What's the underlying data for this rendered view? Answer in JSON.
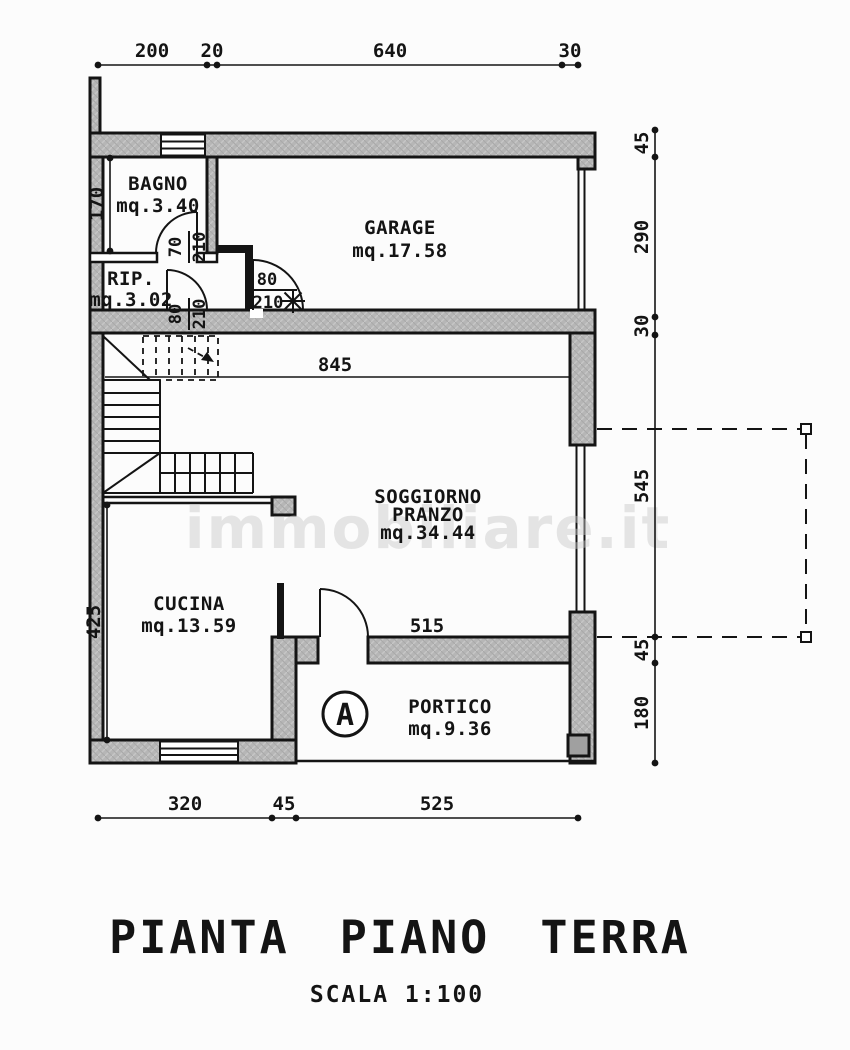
{
  "page": {
    "title": "PIANTA PIANO TERRA",
    "scale": "SCALA 1:100",
    "watermark": "immobiliare.it",
    "section_marker": "A"
  },
  "rooms": {
    "bagno": {
      "name": "BAGNO",
      "area": "mq.3.40"
    },
    "rip": {
      "name": "RIP.",
      "area": "mq.3.02"
    },
    "garage": {
      "name": "GARAGE",
      "area": "mq.17.58"
    },
    "soggiorno": {
      "line1": "SOGGIORNO",
      "line2": "PRANZO",
      "area": "mq.34.44"
    },
    "cucina": {
      "name": "CUCINA",
      "area": "mq.13.59"
    },
    "portico": {
      "name": "PORTICO",
      "area": "mq.9.36"
    }
  },
  "dims": {
    "top": [
      "200",
      "20",
      "640",
      "30"
    ],
    "right": [
      "45",
      "290",
      "30",
      "545",
      "45",
      "180"
    ],
    "bottom": [
      "320",
      "45",
      "525"
    ],
    "soggiorno_width": "845",
    "portico_width": "515",
    "bagno_height": "170",
    "cucina_height": "425"
  },
  "doors": {
    "bagno": {
      "w": "70",
      "h": "210"
    },
    "rip": {
      "w": "80",
      "h": "210"
    },
    "garage": {
      "w": "80",
      "h": "210"
    }
  },
  "colors": {
    "wall_fill": "#b6b6b6",
    "line": "#141414",
    "background": "#fcfcfc",
    "watermark": "#c9c9c9"
  }
}
